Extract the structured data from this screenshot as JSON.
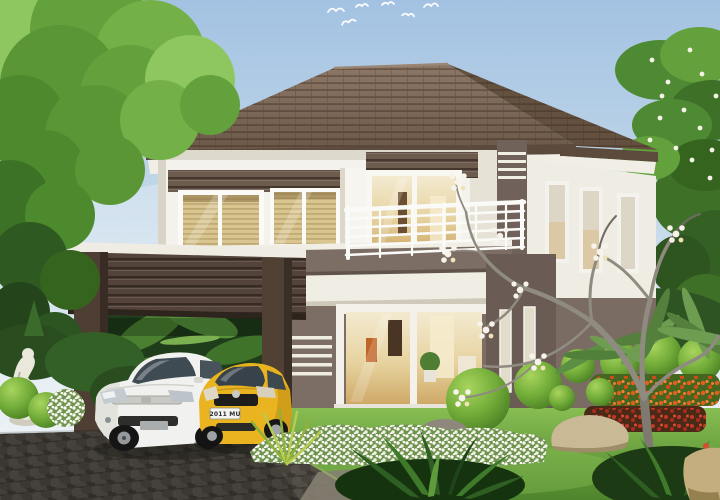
{
  "scene": {
    "description": "Architectural rendering of a modern two-storey house with tiled hip roof, balcony, carport, lit glass doors, landscaped tropical garden, cobblestone driveway and two parked cars under a blue sky with birds",
    "sky": {
      "birds": 6
    },
    "house": {
      "storeys": 2,
      "roof": "brown tiled hip roof",
      "walls": "white with brown horizontal slat accents",
      "balcony_railing": "white horizontal bar railing",
      "carport": "dark brown slatted beam on square posts",
      "glass_doors": "sliding doors with warm lit interior"
    },
    "cars": [
      {
        "label": "white sedan",
        "color": "#f1f1ef",
        "plate": ""
      },
      {
        "label": "yellow hatchback",
        "color": "#e9b41f",
        "plate": "2011 MU"
      }
    ],
    "garden": {
      "left": [
        "white abstract statue",
        "clipped hedges",
        "white flowering shrub"
      ],
      "right": [
        "plumeria tree with white blossoms",
        "fan palms",
        "topiary spheres",
        "orange flower bed",
        "red flower bed",
        "sandstone rocks"
      ],
      "front": [
        "white flowering border",
        "lawn",
        "cobblestone driveway",
        "dark tropical foliage"
      ]
    }
  },
  "palette": {
    "sky_top": "#a3c2e2",
    "sky_low": "#e9f0f5",
    "roof": "#7d6857",
    "roof_dark": "#63503f",
    "fascia_white": "#f1eee5",
    "wall_white": "#f4f2ec",
    "wall_shade": "#e2ddd2",
    "slat_brown": "#6d5b4e",
    "taupe": "#7d6e65",
    "taupe_dark": "#6a5c54",
    "carport": "#53433a",
    "carport_dark": "#3c3029",
    "glass_warm": "#ead9a8",
    "glass_deep": "#c7a55e",
    "blind": "#d8c58f",
    "railing": "#fafaf8",
    "lawn": "#79b249",
    "lawn_dark": "#4e842c",
    "tree": "#63a13c",
    "tree_dark": "#2e5a21",
    "tree_light": "#8ec75f",
    "topiary": "#7cb83e",
    "flower_orange": "#dd5c1e",
    "flower_red": "#bf3320",
    "bloom_white": "#f4f1e6",
    "car_white": "#f1f1ef",
    "car_yellow": "#e9b41f",
    "glass_tint": "#3f4b53",
    "drive": "#45413a",
    "rock": "#c9b994",
    "branch": "#8f8b81",
    "statue": "#eae8db",
    "plate_text": "#2b2b33"
  }
}
